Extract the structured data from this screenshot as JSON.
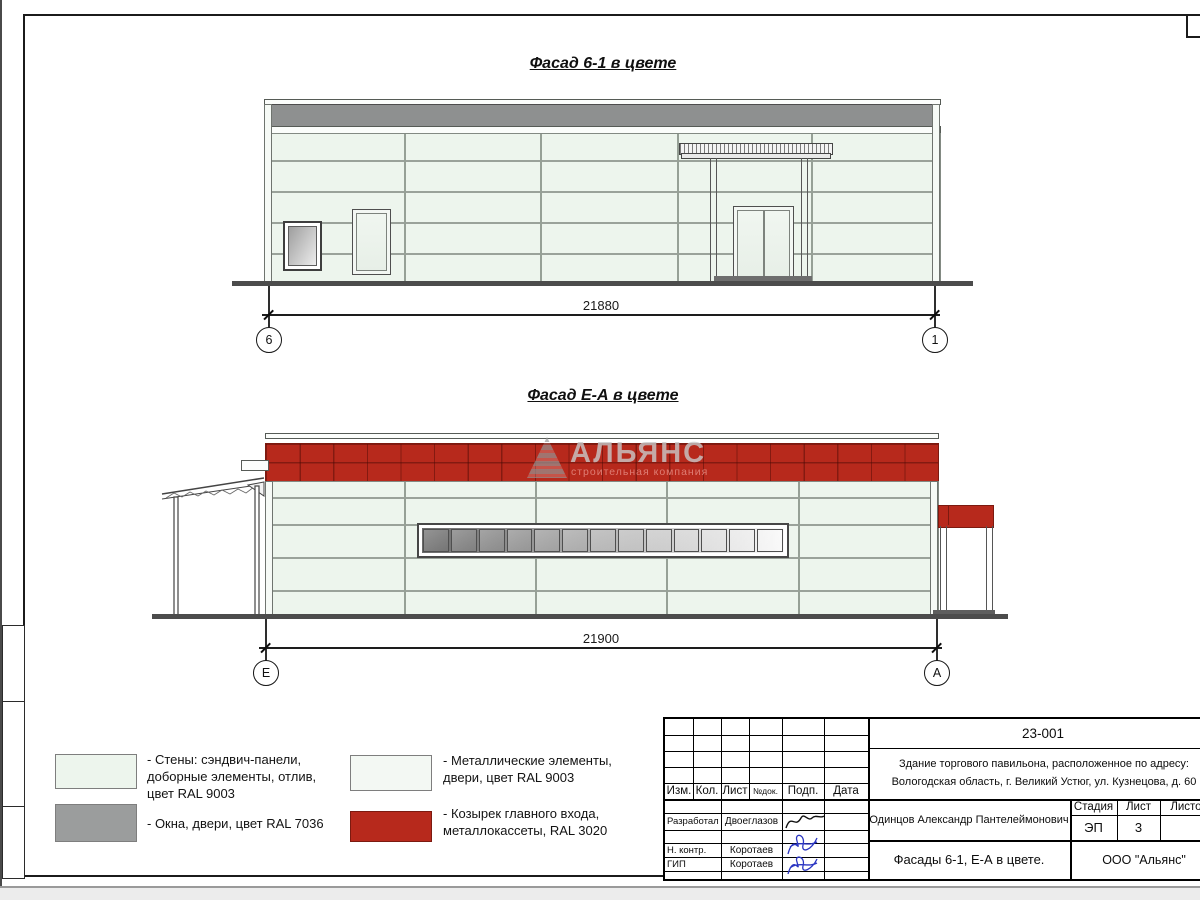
{
  "titles": {
    "facade1": "Фасад 6-1 в цвете",
    "facade2": "Фасад Е-А в цвете"
  },
  "facade1": {
    "dimension": "21880",
    "axis_left": "6",
    "axis_right": "1"
  },
  "facade2": {
    "dimension": "21900",
    "axis_left": "Е",
    "axis_right": "А"
  },
  "watermark": {
    "name": "АЛЬЯНС",
    "tagline": "строительная компания"
  },
  "legend": {
    "items": [
      {
        "text": "- Стены: сэндвич-панели,\nдоборные элементы, отлив,\nцвет RAL 9003"
      },
      {
        "text": "- Окна, двери, цвет RAL 7036"
      },
      {
        "text": "- Металлические элементы,\nдвери, цвет RAL 9003"
      },
      {
        "text": "- Козырек главного входа,\nметаллокассеты, RAL 3020"
      }
    ]
  },
  "colors": {
    "wall_ral9003": "#edf5ed",
    "gray_ral7036": "#9b9d9d",
    "red_ral3020": "#b7291c",
    "parapet_gray": "#8e9090"
  },
  "title_block": {
    "doc_number": "23-001",
    "object_line1": "Здание торгового павильона, расположенное по адресу:",
    "object_line2": "Вологодская область, г. Великий Устюг, ул. Кузнецова, д. 60",
    "cols": [
      "Изм.",
      "Кол.",
      "Лист",
      "№док.",
      "Подп.",
      "Дата"
    ],
    "sign_rows": [
      {
        "role": "Разработал",
        "name": "Двоеглазов"
      },
      {
        "role": "Н. контр.",
        "name": "Коротаев"
      },
      {
        "role": "ГИП",
        "name": "Коротаев"
      }
    ],
    "approver": "Одинцов Александр Пантелеймонович",
    "stage_label": "Стадия",
    "sheet_label": "Лист",
    "sheets_label": "Листов",
    "stage_value": "ЭП",
    "sheet_value": "3",
    "sheets_value": "",
    "sheet_title": "Фасады 6-1, Е-А в цвете.",
    "company": "ООО \"Альянс\""
  }
}
